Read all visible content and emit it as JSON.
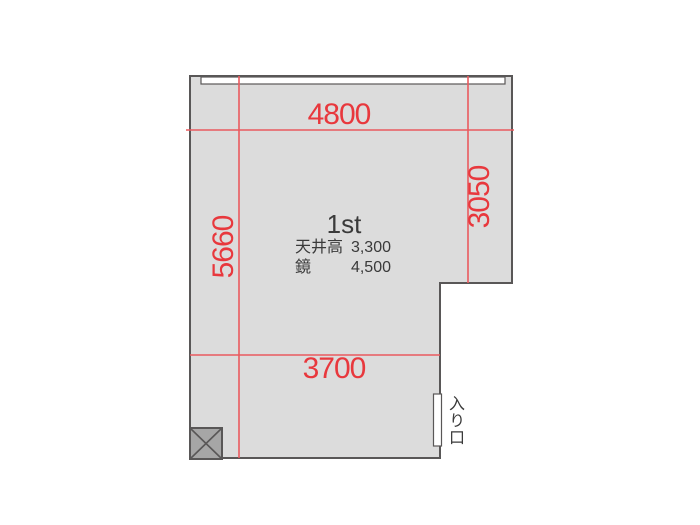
{
  "colors": {
    "background": "#ffffff",
    "room_fill": "#dcdcdc",
    "wall": "#595757",
    "dimension_red": "#e8383d",
    "dimension_line": "#ea5a5e",
    "text_dark": "#3a3a3a",
    "column_fill": "#a6a6a6"
  },
  "floor_plan": {
    "room_label": "1st",
    "dimensions": {
      "top": "4800",
      "right": "3050",
      "left": "5660",
      "bottom": "3700"
    },
    "specs": [
      {
        "label": "天井高",
        "value": "3,300"
      },
      {
        "label": "鏡",
        "value": "4,500"
      }
    ],
    "entrance_label": "入り口"
  }
}
